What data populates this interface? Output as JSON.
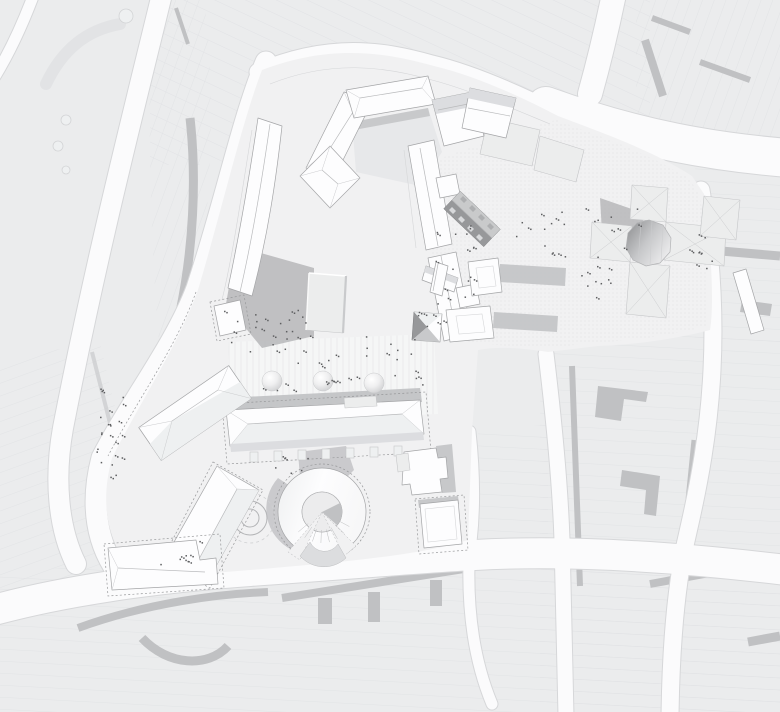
{
  "meta": {
    "title": "Architectural site plan — grayscale urban figure-ground",
    "canvas": {
      "width": 780,
      "height": 712
    }
  },
  "colors": {
    "street": "#fbfbfc",
    "casing": "#d6d7d9",
    "block": "#ebeced",
    "parcel": "#dddee1",
    "shadow": "#c0c1c3",
    "shadow2": "#b4b5b7",
    "site": "#f1f1f2",
    "plaza": "#f5f6f6",
    "roof": "#fdfdfe",
    "roofline": "#a4a5a7",
    "darkroof": "#97989a",
    "court": "#e7e8ea",
    "people": "#5d5e60",
    "dome_edge": "#c9cacc"
  },
  "features": {
    "context_fabric": "existing city blocks with parcel lines",
    "street_network": "white street network",
    "site_ground": "project site ground plane",
    "paved_plaza": "striped central plaza",
    "dotted_paving": "gridded paving around church forecourt",
    "north_courtyard_building": "U-shaped courtyard building with hip roofs",
    "northwest_row_building": "long curved gabled row building",
    "east_range_buildings": "pair of long white slab buildings with court annexes",
    "dark_gable_building": "dark double-pitch roof building with skylights",
    "chapel_building": "small cross-gabled chapel",
    "tower_building": "flat-top tower casting shadow",
    "market_hall_building": "long hip-roofed hall with arcade posts",
    "rotunda_building": "ring-shaped rotunda with inner court and stairs",
    "forecourt_circles": "concentric circular ground feature",
    "southwest_range": "angled gabled buildings of southwest range",
    "east_flat_buildings": "flat-roofed infill buildings with dashed plot line",
    "church_complex": "cruciform church with faceted drum roof",
    "diagonal_strip_building": "narrow white diagonal roof strip",
    "plaza_fountains": "three domed fountains on plaza",
    "people_dots": "scattered pedestrians",
    "boulevard_median": "tree-lined boulevard median"
  },
  "plaza_fountains": [
    {
      "cx": 272,
      "cy": 381,
      "r": 10
    },
    {
      "cx": 323,
      "cy": 381,
      "r": 10
    },
    {
      "cx": 374,
      "cy": 383,
      "r": 10
    }
  ],
  "forecourt_circles": {
    "cx": 250,
    "cy": 518,
    "radii": [
      17,
      9
    ]
  },
  "rotunda": {
    "cx": 322,
    "cy": 512,
    "outer_r": 44,
    "inner_r": 20,
    "dashed_r": 48
  },
  "people_clusters": [
    {
      "x": 268,
      "y": 330,
      "rx": 45,
      "ry": 22,
      "n": 26
    },
    {
      "x": 320,
      "y": 372,
      "rx": 60,
      "ry": 18,
      "n": 16
    },
    {
      "x": 392,
      "y": 360,
      "rx": 40,
      "ry": 25,
      "n": 14
    },
    {
      "x": 108,
      "y": 430,
      "rx": 16,
      "ry": 48,
      "n": 22
    },
    {
      "x": 455,
      "y": 265,
      "rx": 22,
      "ry": 40,
      "n": 18
    },
    {
      "x": 540,
      "y": 235,
      "rx": 28,
      "ry": 25,
      "n": 14
    },
    {
      "x": 600,
      "y": 272,
      "rx": 25,
      "ry": 28,
      "n": 12
    },
    {
      "x": 705,
      "y": 250,
      "rx": 16,
      "ry": 20,
      "n": 9
    },
    {
      "x": 175,
      "y": 552,
      "rx": 30,
      "ry": 12,
      "n": 8
    },
    {
      "x": 300,
      "y": 462,
      "rx": 25,
      "ry": 12,
      "n": 6
    },
    {
      "x": 430,
      "y": 320,
      "rx": 14,
      "ry": 25,
      "n": 8
    },
    {
      "x": 615,
      "y": 222,
      "rx": 30,
      "ry": 14,
      "n": 8
    }
  ],
  "people_dot_size": 1.5
}
